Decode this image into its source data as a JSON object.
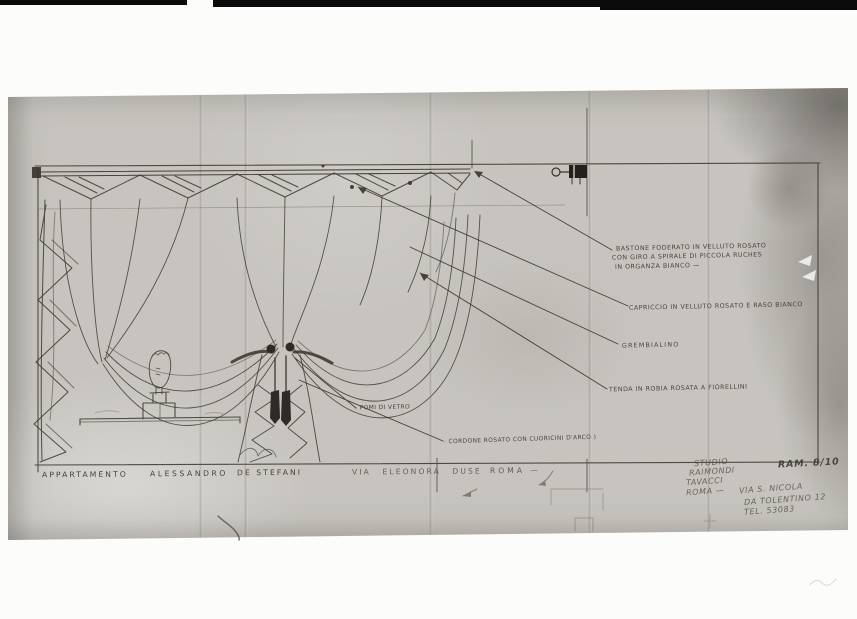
{
  "labels": {
    "bastone": [
      "BASTONE FODERATO IN VELLUTO ROSATO",
      "CON GIRO A SPIRALE DI PICCOLA RUCHES",
      "IN ORGANZA BIANCO —"
    ],
    "capriccio": "CAPRICCIO IN VELLUTO ROSATO E RASO BIANCO",
    "grembialino": "GREMBIALINO",
    "tenda": "TENDA IN ROBIA ROSATA A FIORELLINI",
    "pomi": "- POMI DI VETRO",
    "cordone": "· CORDONE ROSATO CON CUORICINI D'ARCO )"
  },
  "title_row": {
    "project": "APPARTAMENTO",
    "client_first": "ALESSANDRO",
    "client_last": "DE STEFANI",
    "street": "VIA ELEONORA DUSE",
    "city": "ROMA —"
  },
  "studio": {
    "l1": "STUDIO",
    "l2": "RAIMONDI",
    "l3": "TAVACCI",
    "l4": "ROMA —",
    "l5": "VIA S. NICOLA",
    "l6": "DA TOLENTINO 12",
    "l7": "TEL. 53083",
    "sheet": "RAM. 8/10"
  },
  "colors": {
    "paper": "#c7c4bf",
    "ink": "#38342d",
    "pencil": "#6f6a62",
    "film_bar": "#0a0a0a",
    "background": "#fcfcfb"
  }
}
